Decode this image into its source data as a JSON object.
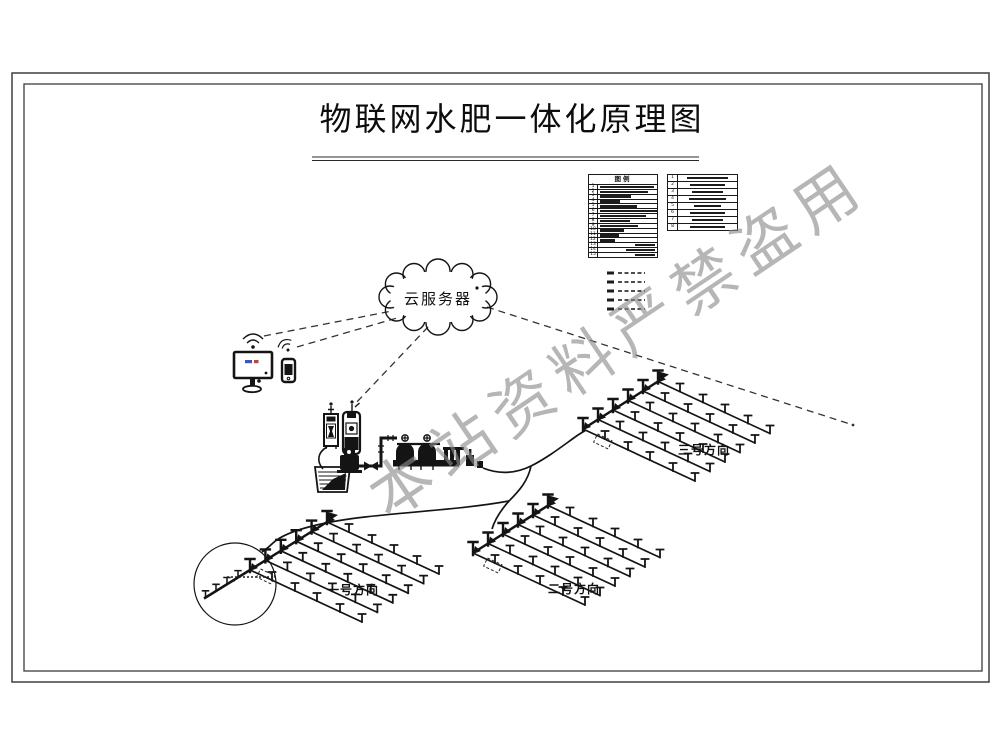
{
  "title": "物联网水肥一体化原理图",
  "cloud": {
    "label": "云服务器"
  },
  "watermark": {
    "text": "本站资料严禁盗用"
  },
  "legend": {
    "title": "图例",
    "left_rows": [
      "1",
      "2",
      "3",
      "4",
      "5",
      "6",
      "7",
      "8",
      "9",
      "10",
      "11",
      "12",
      "13",
      "14",
      "15"
    ],
    "right_rows": [
      "1",
      "2",
      "3",
      "4",
      "5",
      "6",
      "7",
      "8"
    ]
  },
  "fields": [
    {
      "label": "一号方向"
    },
    {
      "label": "二号方向"
    },
    {
      "label": "三号方向"
    }
  ],
  "colors": {
    "ink": "#141414",
    "watermark_gray": "#8a8a8a",
    "screen_blue": "#3a55c4",
    "screen_red": "#c0452a"
  }
}
